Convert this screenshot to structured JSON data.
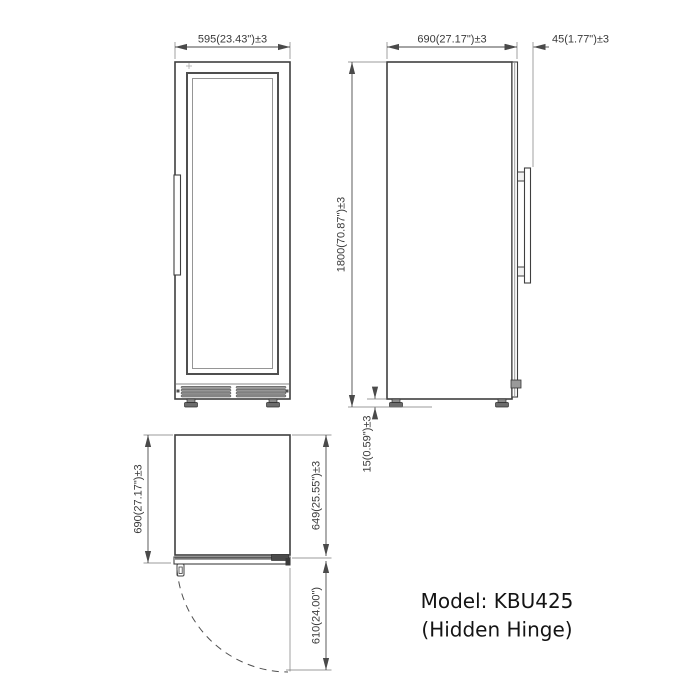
{
  "colors": {
    "background": "#ffffff",
    "drawing_line": "#3f3f3f",
    "dimension_line": "#4a4a4a",
    "dimension_text": "#3a3a3a",
    "model_text": "#141414"
  },
  "front_view": {
    "width_dim": "595(23.43\")±3"
  },
  "side_view": {
    "depth_dim": "690(27.17\")±3",
    "door_thickness_dim": "45(1.77\")±3",
    "height_dim": "1800(70.87\")±3",
    "foot_height_dim": "15(0.59\")±3"
  },
  "top_view": {
    "total_depth_dim": "690(27.17\")±3",
    "body_depth_dim": "649(25.55\")±3",
    "door_swing_dim": "610(24.00\")"
  },
  "model_label": {
    "line1": "Model: KBU425",
    "line2": "(Hidden Hinge)"
  }
}
